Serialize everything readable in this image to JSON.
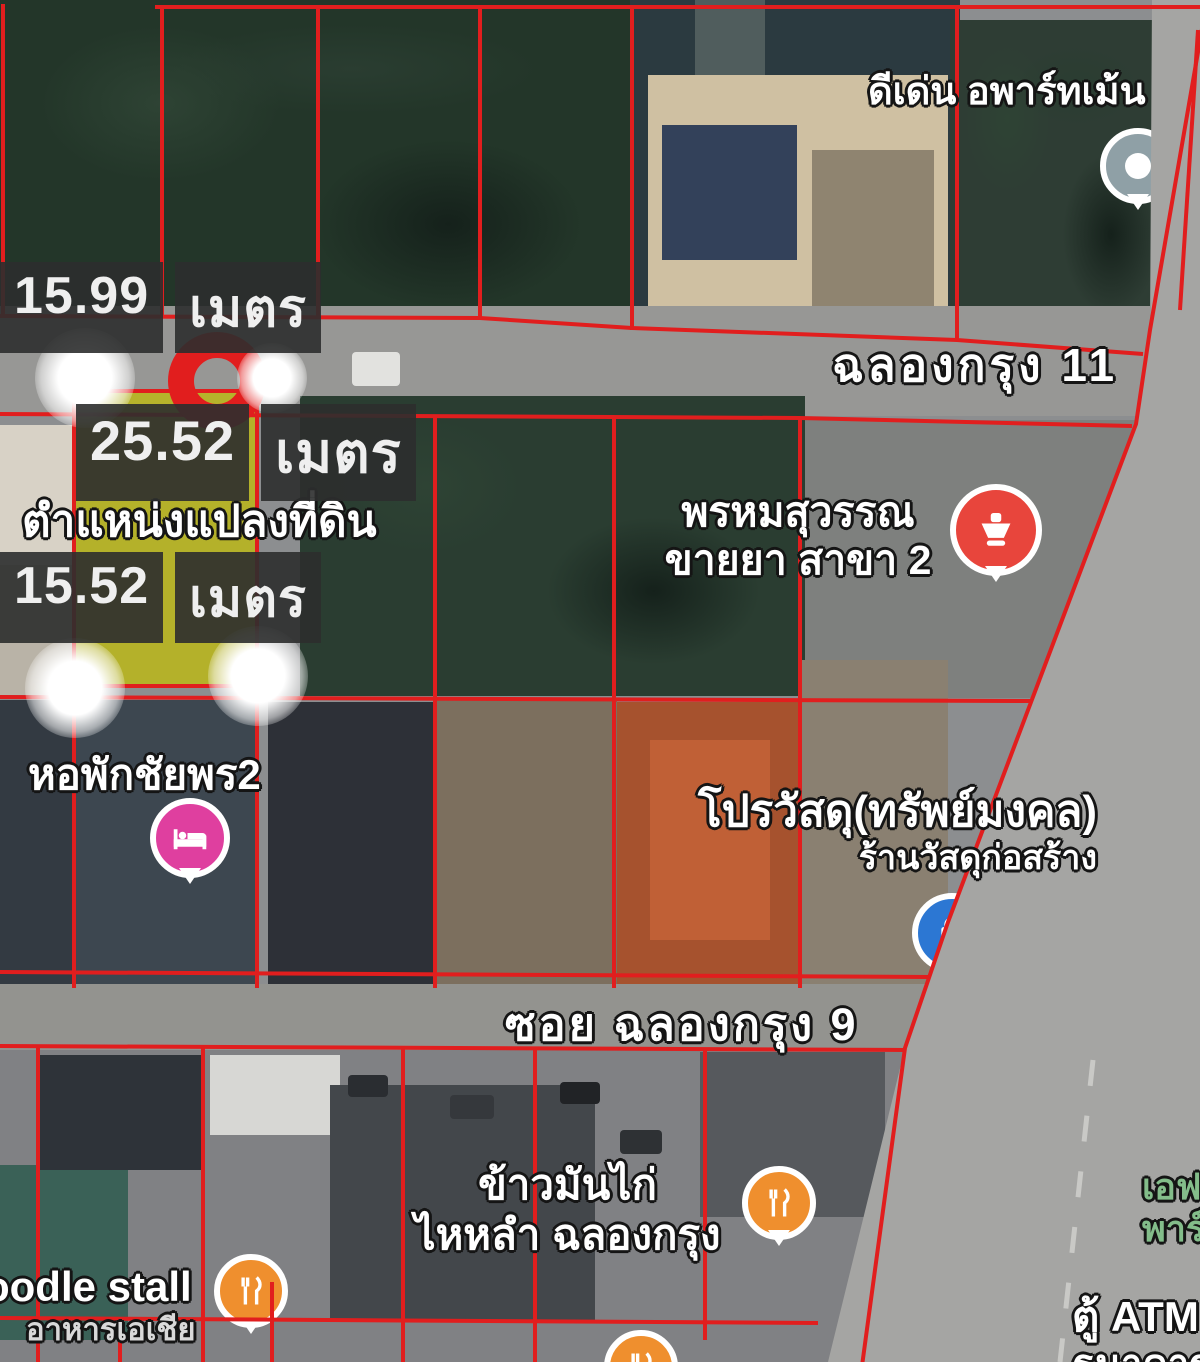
{
  "colors": {
    "boundary-red": "#e11e1e",
    "plot-yellow": "rgba(190,186,16,0.8)",
    "marker-red": "#e8453c",
    "marker-pink": "#df3f9f",
    "marker-blue": "#2c77d3",
    "marker-orange": "#ef8f2e",
    "marker-gray": "#8fa0a6",
    "label-box-bg": "rgba(44,46,45,0.9)",
    "park-green": "#83bd8a",
    "road-gray": "#a5a5a3"
  },
  "measurements": {
    "m1": {
      "value": "15.99",
      "unit": "เมตร"
    },
    "m2": {
      "value": "25.52",
      "unit": "เมตร"
    },
    "m3": {
      "value": "15.52",
      "unit": "เมตร"
    }
  },
  "plot": {
    "label": "ตำแหน่งแปลงที่ดิน"
  },
  "roads": {
    "road11": "ฉลองกรุง 11",
    "soi9": "ซอย ฉลองกรุง 9"
  },
  "pois": {
    "apartment": {
      "name": "ดีเด่น อพาร์ทเม้น"
    },
    "pharmacy": {
      "line1": "พรหมสุวรรณ",
      "line2": "ขายยา สาขา 2"
    },
    "dorm": {
      "name": "หอพักชัยพร2"
    },
    "materials": {
      "line1": "โปรวัสดุ(ทรัพย์มงคล)",
      "line2": "ร้านวัสดุก่อสร้าง"
    },
    "chicken_rice": {
      "line1": "ข้าวมันไก่",
      "line2": "ไหหลำ ฉลองกรุง"
    },
    "noodle": {
      "line1": "oodle stall",
      "line2": "อาหารเอเชีย"
    },
    "atm": {
      "line1": "ตู้ ATM",
      "line2": "ธนาคาร"
    },
    "park": {
      "line1": "เอฟ",
      "line2": "พาร์"
    }
  }
}
